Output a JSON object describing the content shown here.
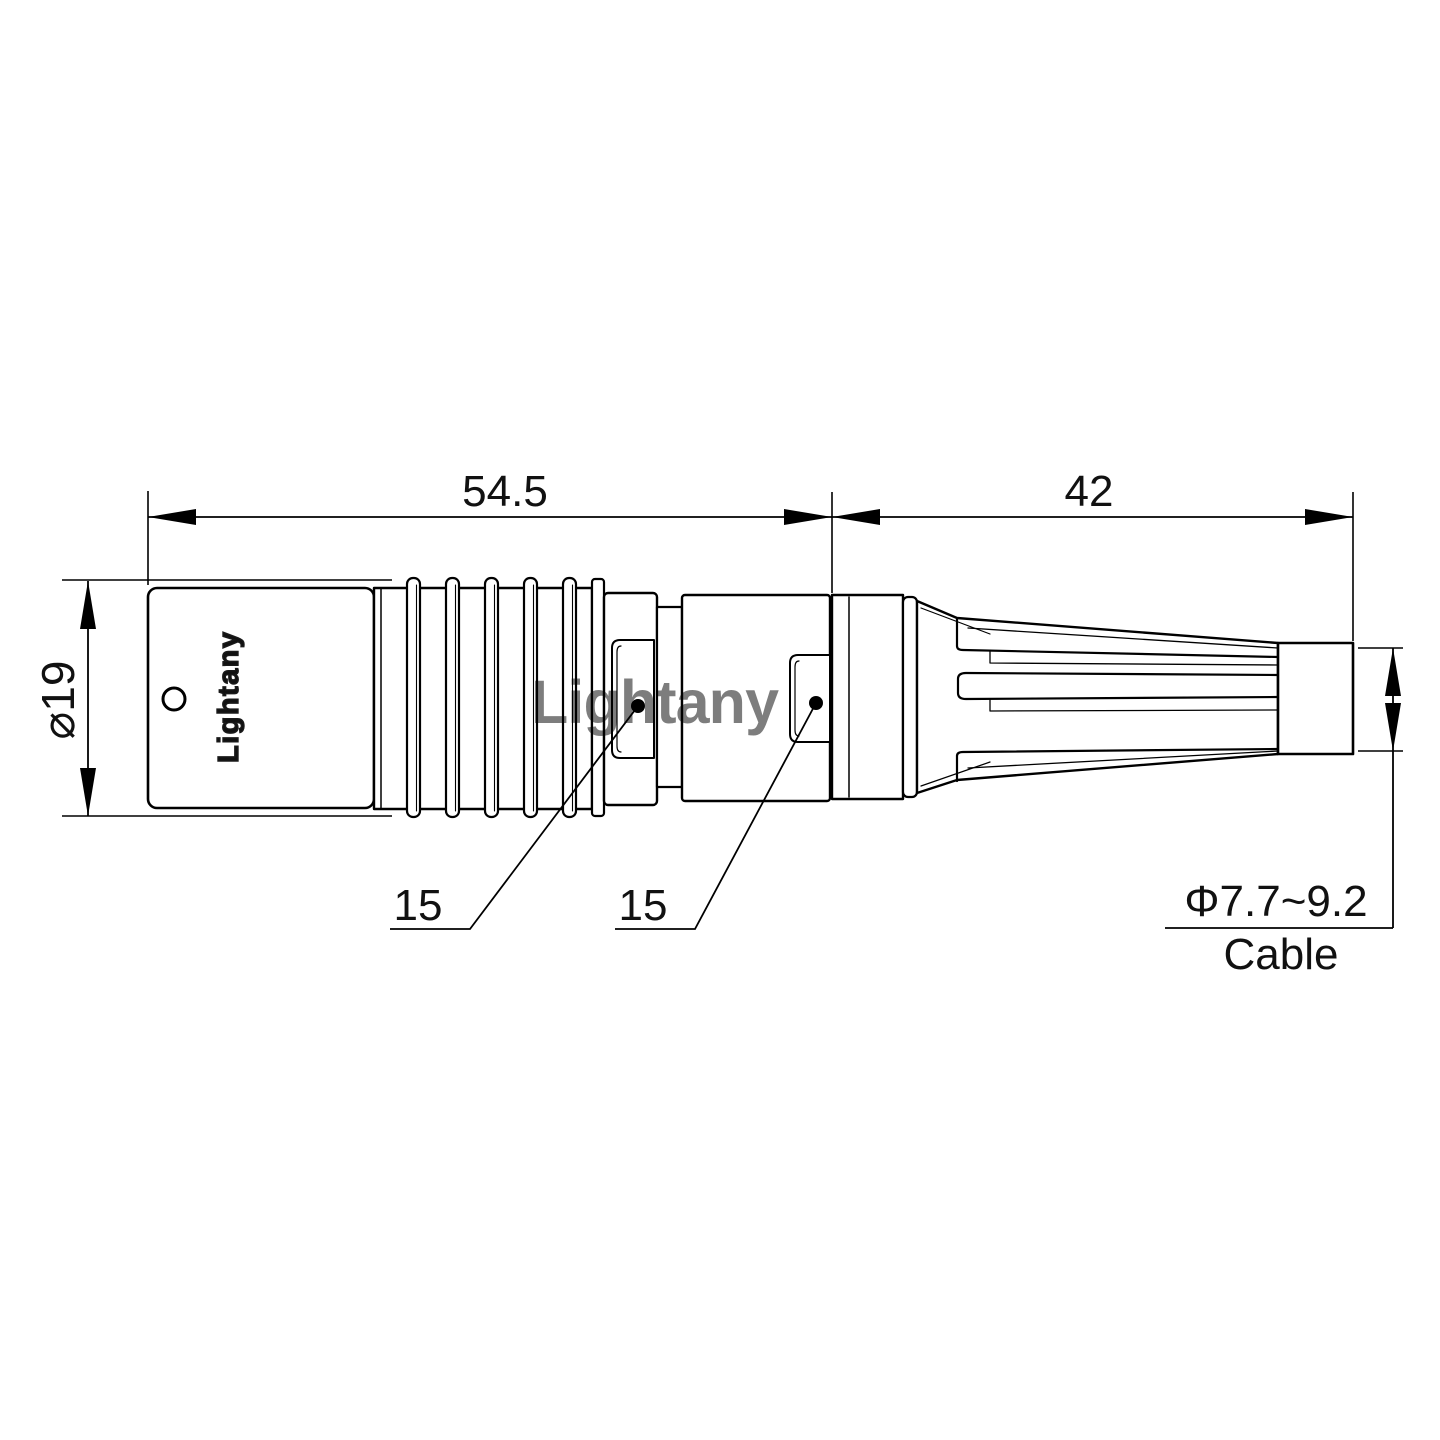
{
  "drawing": {
    "title": "circular push-pull connector with cable strain relief - side view technical drawing",
    "background_color": "#ffffff",
    "line_color": "#000000",
    "watermark": {
      "text": "Lightany",
      "color": "#e89a9a"
    },
    "body_marking": {
      "text": "Lightany"
    },
    "dimensions": {
      "front_length": {
        "value": "54.5"
      },
      "rear_length": {
        "value": "42"
      },
      "shell_diameter": {
        "value": "⌀19"
      },
      "coupling_flat_1": {
        "value": "15"
      },
      "coupling_flat_2": {
        "value": "15"
      },
      "cable_diameter_range": {
        "value": "Φ7.7~9.2"
      },
      "cable_label": {
        "value": "Cable"
      }
    }
  }
}
